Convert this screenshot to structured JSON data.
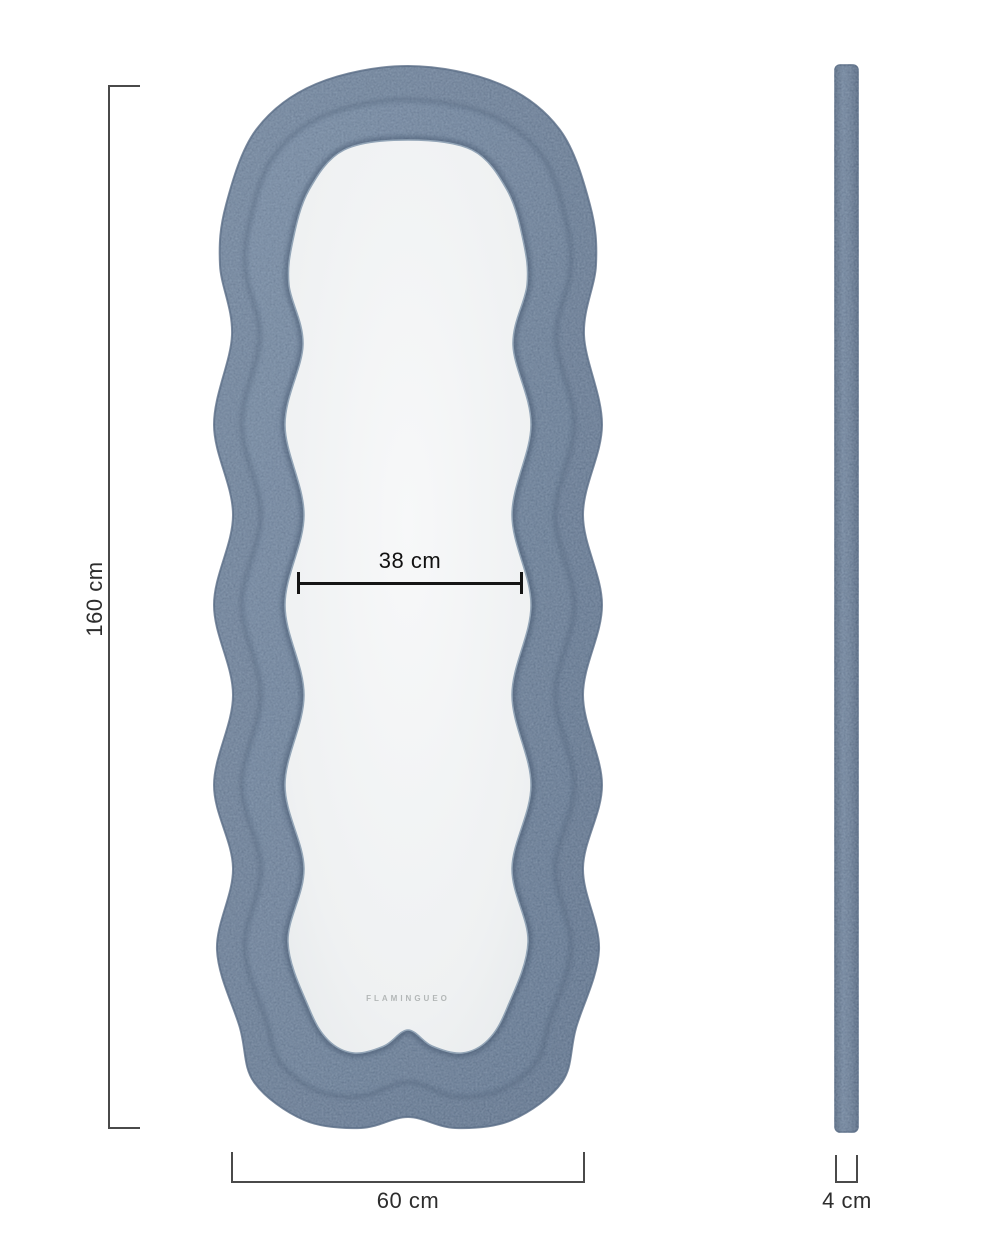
{
  "product": {
    "brand_watermark": "FLAMINGUEO"
  },
  "dimensions": {
    "height": {
      "label": "160 cm"
    },
    "width": {
      "label": "60 cm"
    },
    "inner_width": {
      "label": "38 cm"
    },
    "depth": {
      "label": "4 cm"
    }
  },
  "colors": {
    "frame_fabric": "#76889f",
    "frame_fabric_light": "#8a9cb2",
    "frame_fabric_dark": "#5e718a",
    "glass": "#f2f4f5",
    "dimension_line": "#4a4a4a",
    "inner_dimension_line": "#161616",
    "watermark_text": "#b3b7b7",
    "background": "#ffffff"
  }
}
